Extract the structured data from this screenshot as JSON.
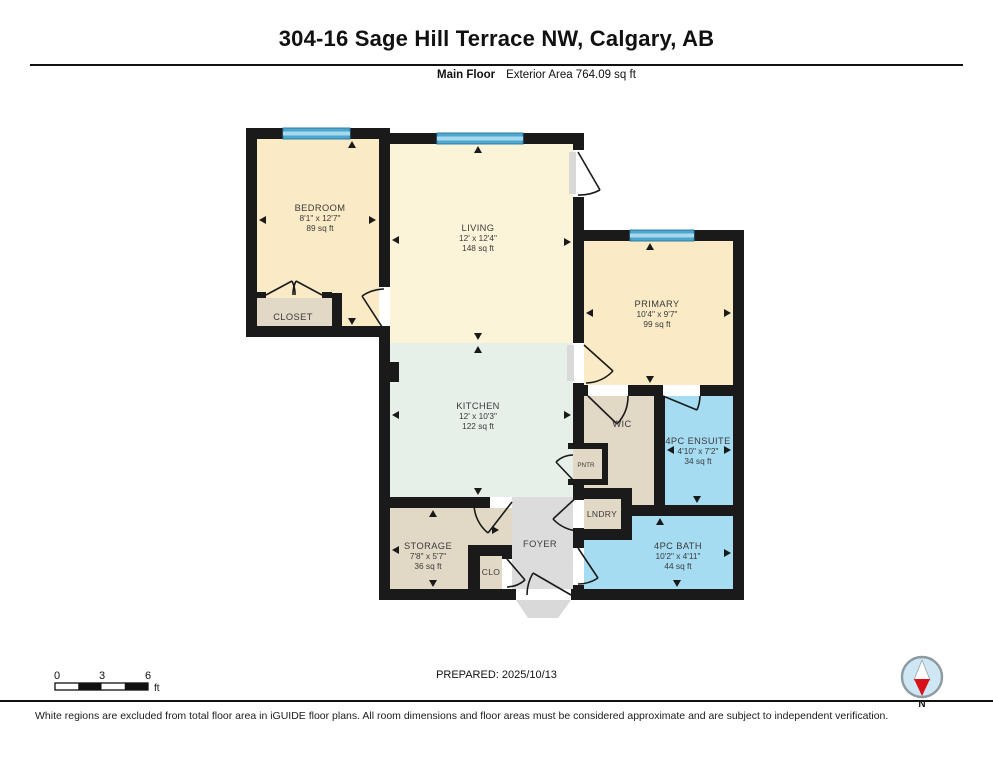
{
  "header": {
    "title": "304-16 Sage Hill Terrace NW, Calgary, AB",
    "floor_label": "Main Floor",
    "area_label": "Exterior Area 764.09 sq ft"
  },
  "rooms": {
    "bedroom": {
      "name": "BEDROOM",
      "dims": "8'1\" x 12'7\"",
      "area": "89 sq ft"
    },
    "living": {
      "name": "LIVING",
      "dims": "12' x 12'4\"",
      "area": "148 sq ft"
    },
    "primary": {
      "name": "PRIMARY",
      "dims": "10'4\" x 9'7\"",
      "area": "99 sq ft"
    },
    "kitchen": {
      "name": "KITCHEN",
      "dims": "12' x 10'3\"",
      "area": "122 sq ft"
    },
    "ensuite": {
      "name": "4PC ENSUITE",
      "dims": "4'10\" x 7'2\"",
      "area": "34 sq ft"
    },
    "bath": {
      "name": "4PC BATH",
      "dims": "10'2\" x 4'11\"",
      "area": "44 sq ft"
    },
    "storage": {
      "name": "STORAGE",
      "dims": "7'8\" x 5'7\"",
      "area": "36 sq ft"
    },
    "closet": {
      "name": "CLOSET"
    },
    "wic": {
      "name": "WIC"
    },
    "pantry": {
      "name": "PNTR"
    },
    "laundry": {
      "name": "LNDRY"
    },
    "clo": {
      "name": "CLO"
    },
    "foyer": {
      "name": "FOYER"
    }
  },
  "scale_bar": {
    "tick_0": "0",
    "tick_3": "3",
    "tick_6": "6",
    "unit": "ft"
  },
  "footer": {
    "prepared": "PREPARED: 2025/10/13",
    "compass_label": "N",
    "disclaimer": "White regions are excluded from total floor area in iGUIDE floor plans. All room dimensions and floor areas must be considered approximate and are subject to independent verification."
  },
  "colors": {
    "wall": "#1a1a1a",
    "bedroom_fill": "#FAEAC5",
    "living_fill": "#FCF4D9",
    "kitchen_fill": "#E6EFE8",
    "wet_room_fill": "#A5DCF2",
    "closet_fill": "#E2D8C6",
    "foyer_fill": "#DCDCDC",
    "window_blue": "#4DA6CE",
    "compass_red": "#D8121B"
  }
}
